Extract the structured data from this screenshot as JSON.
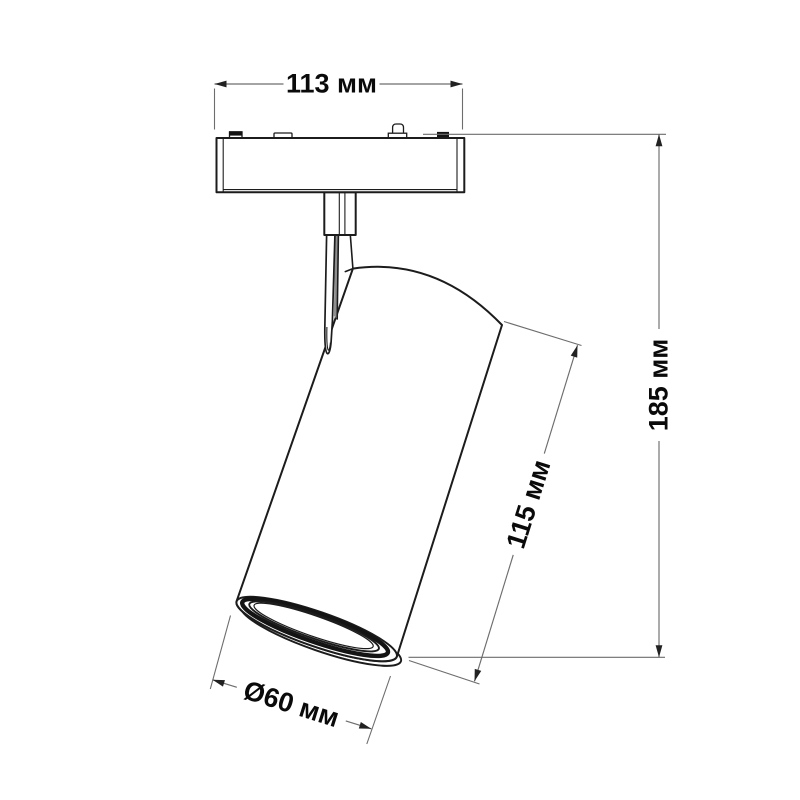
{
  "drawing": {
    "subject": "track-mounted-spotlight",
    "dimensions": {
      "width": {
        "label": "113 мм",
        "value": 113,
        "unit": "мм"
      },
      "height": {
        "label": "185 мм",
        "value": 185,
        "unit": "мм"
      },
      "body_length": {
        "label": "115 мм",
        "value": 115,
        "unit": "мм"
      },
      "diameter": {
        "label": "Ø60 мм",
        "value": 60,
        "unit": "мм"
      }
    },
    "colors": {
      "background": "#ffffff",
      "outline": "#1c1c1c",
      "dimension_line": "#6d6d6d",
      "arrow": "#222222",
      "label_text": "#0a0a0a",
      "slot_shade": "#8f8f8f"
    }
  }
}
